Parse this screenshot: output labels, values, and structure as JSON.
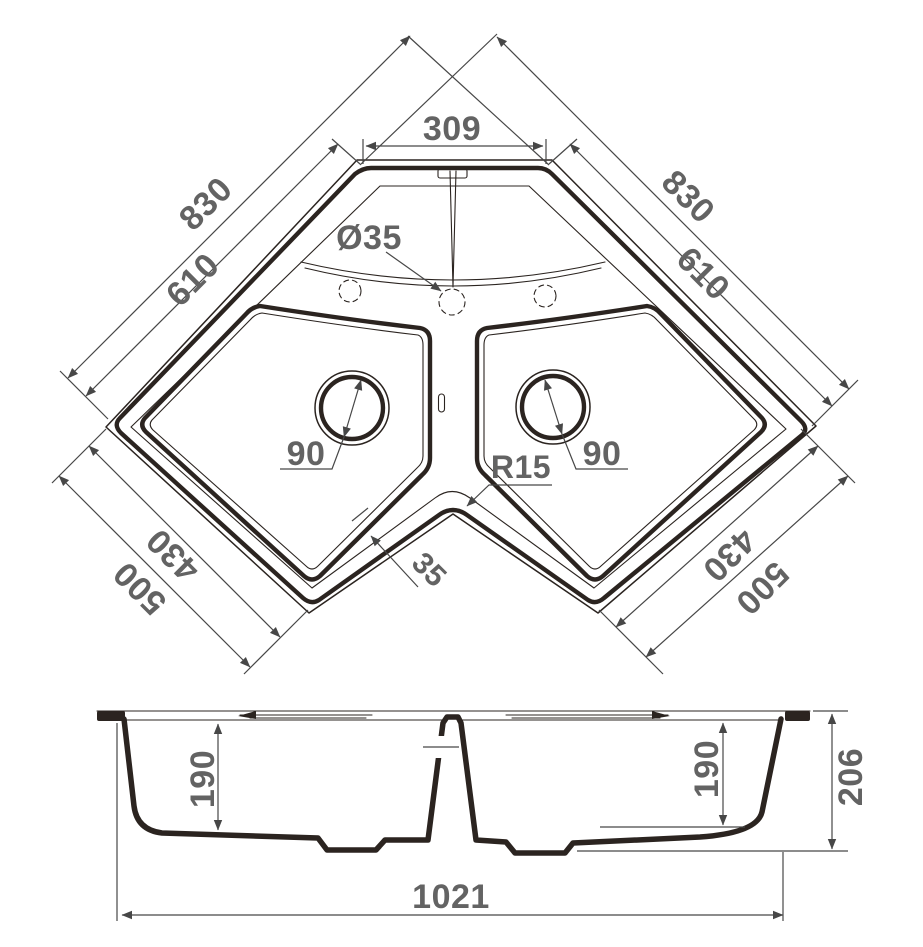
{
  "plan_view": {
    "top_width": "309",
    "side_total_left": "830",
    "side_bowl_left": "610",
    "side_total_right": "830",
    "side_bowl_right": "610",
    "front_bowl_left": "430",
    "front_total_left": "500",
    "front_bowl_right": "430",
    "front_total_right": "500",
    "faucet_hole_diameter": "Ø35",
    "drain_diameter_left": "90",
    "drain_diameter_right": "90",
    "inner_corner_radius": "R15",
    "rim_width": "35"
  },
  "section_view": {
    "bowl_depth_left": "190",
    "bowl_depth_right": "190",
    "overall_height": "206",
    "overall_width": "1021"
  },
  "colors": {
    "line": "#2b2420",
    "dim_line": "#474747",
    "dim_text": "#636363",
    "background": "#ffffff"
  }
}
